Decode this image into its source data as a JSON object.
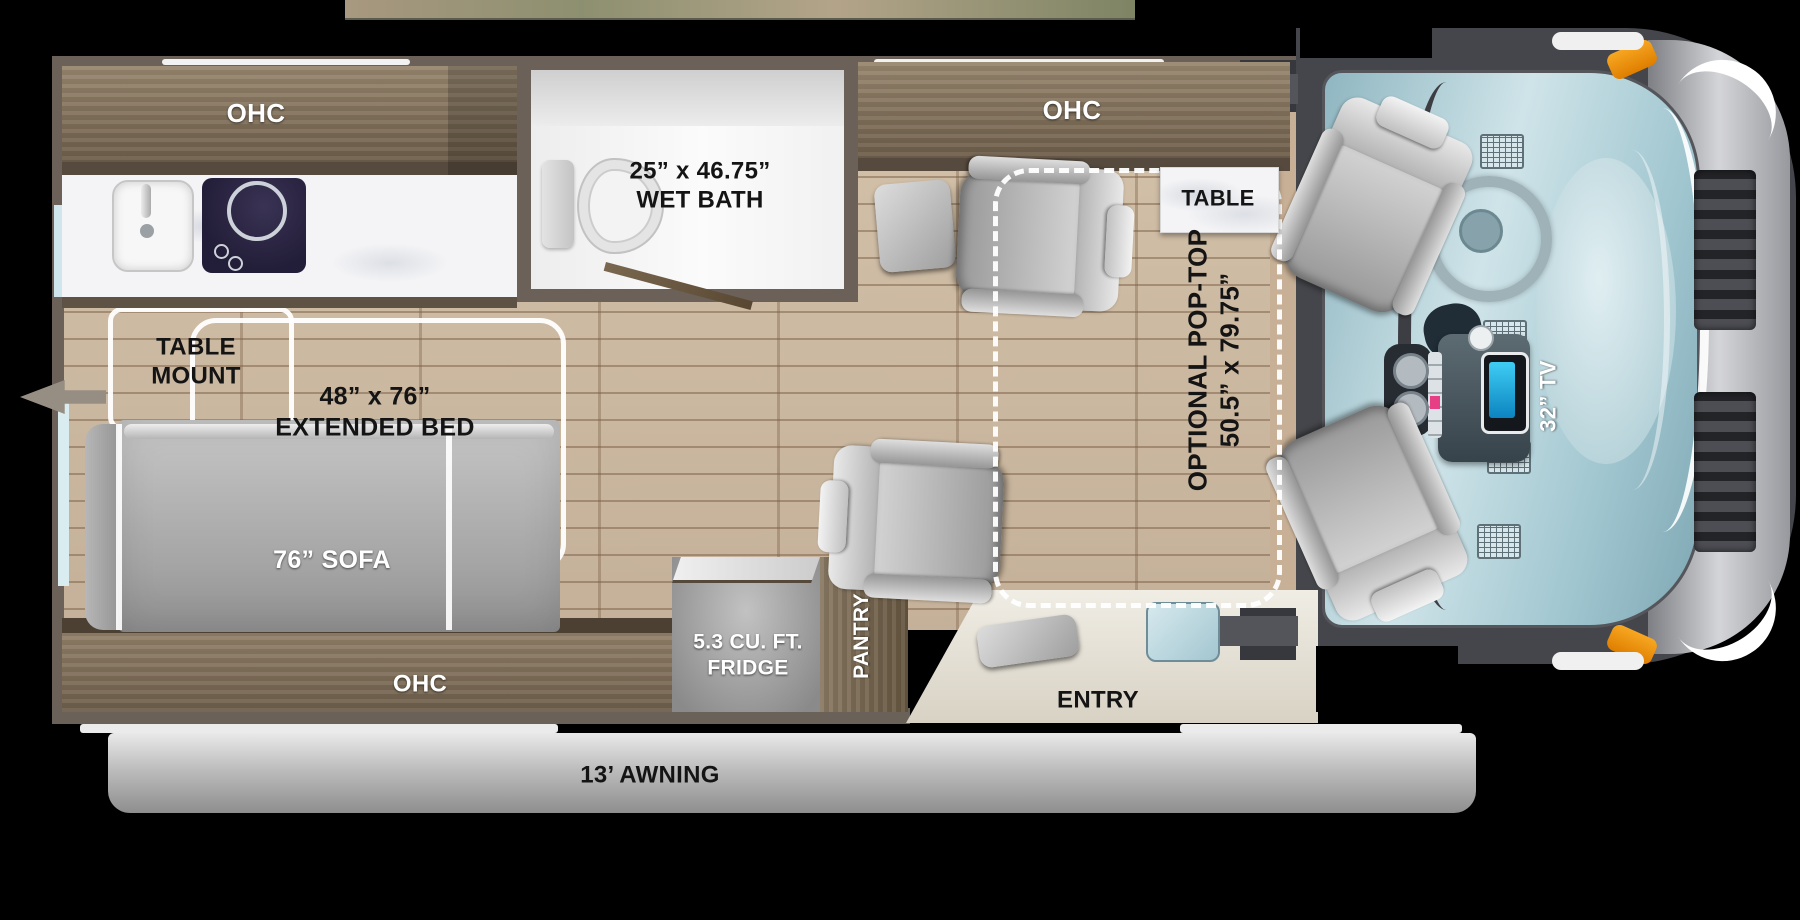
{
  "colors": {
    "background": "#000000",
    "wall": "#6b6159",
    "wood": "#8a7a66",
    "floor_plank": "#cdbba4",
    "marble": "#f4f4f6",
    "seat_gray": "#b9b9b9",
    "pop_top_dash": "#ffffff",
    "dash_panel_blue": "#b7d4dc",
    "tv_screen_blue": "#1fa8dc",
    "marker_orange": "#ef9a1d",
    "awning_gray": "#bdbdbd"
  },
  "floorplan": {
    "kitchen": {
      "ohc": "OHC"
    },
    "wet_bath": {
      "dimensions": "25” x 46.75”",
      "name": "WET BATH"
    },
    "dinette": {
      "ohc": "OHC",
      "table": "TABLE"
    },
    "bed": {
      "table_mount_line1": "TABLE",
      "table_mount_line2": "MOUNT",
      "dimensions": "48” x 76”",
      "name": "EXTENDED BED",
      "sofa": "76” SOFA"
    },
    "galley": {
      "ohc": "OHC",
      "fridge_line1": "5.3 CU. FT.",
      "fridge_line2": "FRIDGE",
      "pantry": "PANTRY"
    },
    "entry": {
      "name": "ENTRY"
    },
    "pop_top": {
      "line1": "OPTIONAL POP-TOP",
      "line2": "50.5” x 79.75”"
    },
    "cab": {
      "tv": "32” TV"
    },
    "awning": {
      "name": "13’ AWNING"
    }
  }
}
